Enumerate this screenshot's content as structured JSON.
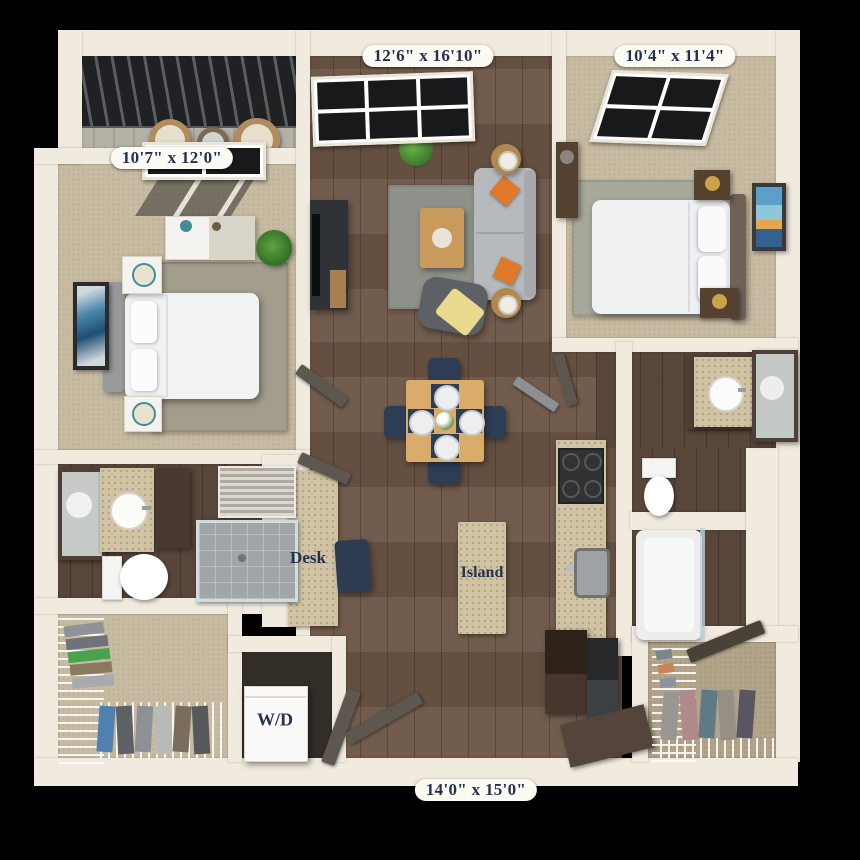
{
  "plan": {
    "rooms": {
      "living_room": {
        "name": "living-room",
        "dimensions": "12'6\" x 16'10\""
      },
      "bedroom_2": {
        "name": "bedroom-2",
        "dimensions": "10'4\" x 11'4\""
      },
      "bedroom_1": {
        "name": "bedroom-1",
        "dimensions": "10'7\" x 12'0\""
      },
      "overall": {
        "name": "overall-unit",
        "dimensions": "14'0\" x 15'0\""
      }
    },
    "features": {
      "desk": "Desk",
      "island": "Island",
      "washer_dryer": "W/D"
    },
    "colors": {
      "background": "#000000",
      "wall": "#f0eadf",
      "wood_floor": "#6b5546",
      "carpet": "#c7bba2",
      "counter": "#cfc3a4",
      "label_bg": "#fbfaf3",
      "label_text": "#23304f",
      "accent_navy": "#2e3d56",
      "accent_orange": "#e07a2a"
    }
  }
}
